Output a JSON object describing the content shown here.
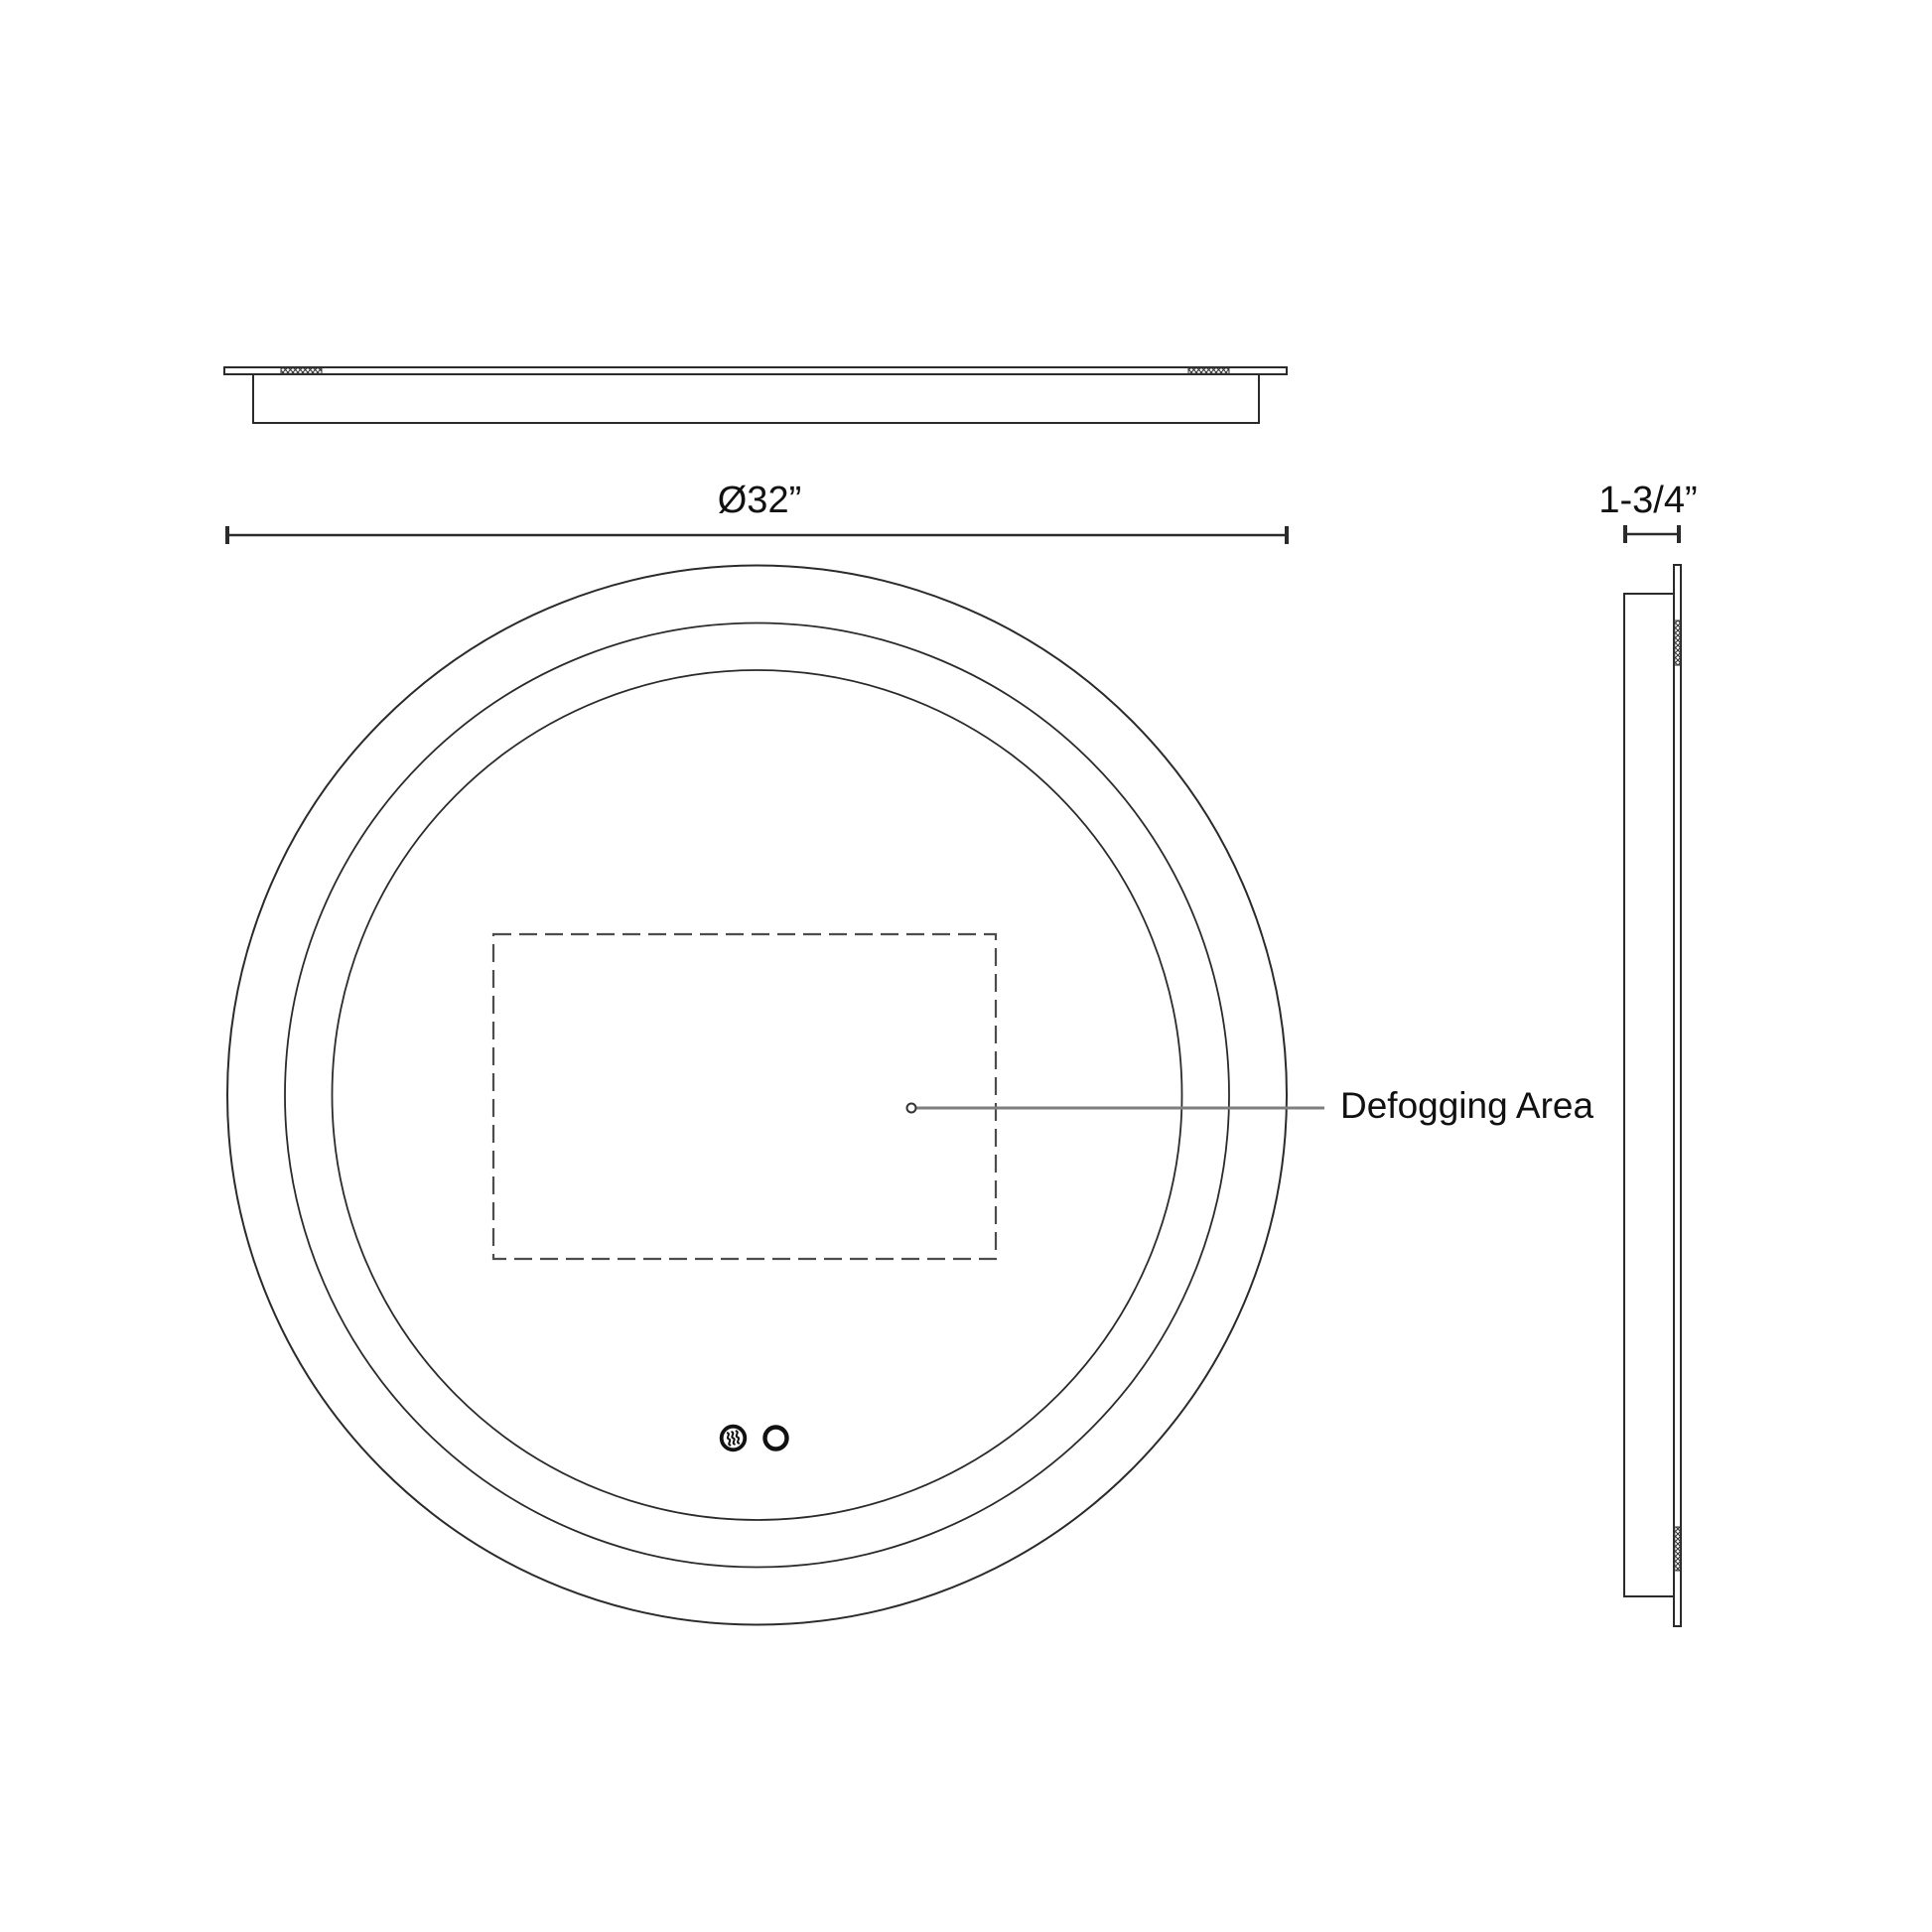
{
  "page": {
    "background": "#ffffff"
  },
  "colors": {
    "line": "#2b2b2b",
    "dashed_outline": "#4d4d4d",
    "leader_line": "#7f7f7f",
    "label_text": "#111111",
    "hatch": "#333333"
  },
  "front_view": {
    "diameter_label": "Ø32”",
    "defogging_label": "Defogging Area"
  },
  "side_view": {
    "depth_label": "1-3/4”"
  },
  "icons": {
    "defogger": "defogger-steam-icon",
    "light": "light-button-icon"
  }
}
